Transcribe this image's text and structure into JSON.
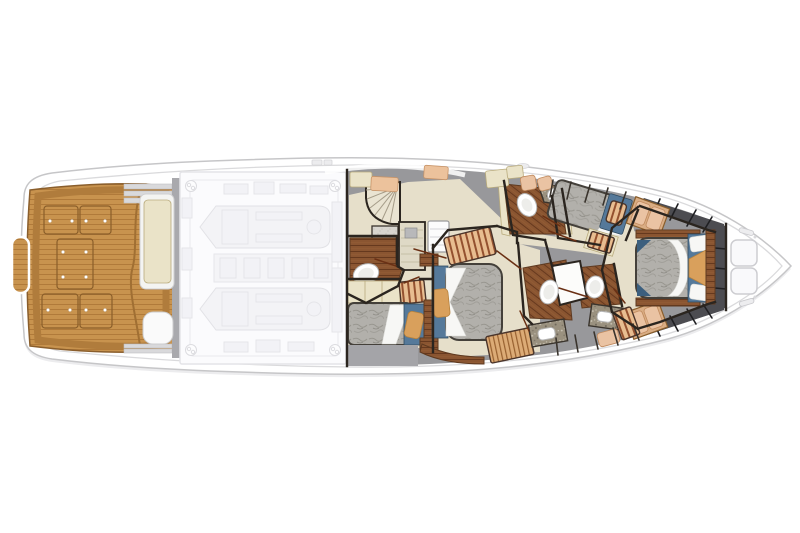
{
  "meta": {
    "description": "Top-down lower-deck floor plan of a sportfish motor yacht, stern at left and bow at right",
    "canvas_width": 800,
    "canvas_height": 533,
    "background": "#ffffff"
  },
  "palette": {
    "hull": "#ffffff",
    "hull_edge": "#c6c6c8",
    "hull_inner_line": "#dadadc",
    "shadow": "#ececee",
    "teak": "#c8934e",
    "teak_line": "#b07a3a",
    "teak_border": "#8a5e2c",
    "deck_gray": "#98989b",
    "band_gray": "#a9a9ad",
    "locker_line": "#3a342d",
    "floor_beige": "#e6dfca",
    "cream": "#eae3c8",
    "wood": "#8a5531",
    "wood_line": "#66391e",
    "mattress": "#b2b0ab",
    "mattress_line": "#98968f",
    "linen_white": "#f7f7f5",
    "bedding_blue": "#55799a",
    "bedding_blue_dark": "#3c5f7e",
    "pillow_tan": "#d9a05c",
    "stripe_base": "#e8bd90",
    "stripe_line": "#94512f",
    "charcoal": "#4c4c51",
    "cushion_pink": "#eac3a3",
    "granite": "#9a917f",
    "wall_dark": "#2b251f",
    "door_brown": "#6a3014",
    "ghost_fill": "#f3f3f6",
    "ghost_line": "#e2e2e6",
    "porcelain": "#ffffff"
  },
  "regions": {
    "cockpit": {
      "name": "cockpit-teak-deck",
      "hatch_count": 5
    },
    "mezzanine": {
      "name": "mezzanine-bench-and-seat"
    },
    "engine_room": {
      "name": "engine-room-ghosted",
      "engine_count": 2
    },
    "companionway": {
      "name": "companionway-stairs"
    },
    "day_head": {
      "name": "aft-head",
      "fixture_count": 1
    },
    "port_cabin": {
      "name": "port-guest-cabin",
      "berth_count": 1
    },
    "master": {
      "name": "midship-stateroom",
      "berth_count": 1
    },
    "mid_head": {
      "name": "starboard-head",
      "fixture_count": 2
    },
    "guest_cabin": {
      "name": "starboard-guest-cabin",
      "berth_count": 1
    },
    "fwd_heads": {
      "name": "forward-heads",
      "head_count": 2
    },
    "vip": {
      "name": "forward-vip-stateroom",
      "berth_count": 1
    },
    "bow_deck": {
      "name": "bow-deck",
      "hatch_count": 2
    }
  }
}
